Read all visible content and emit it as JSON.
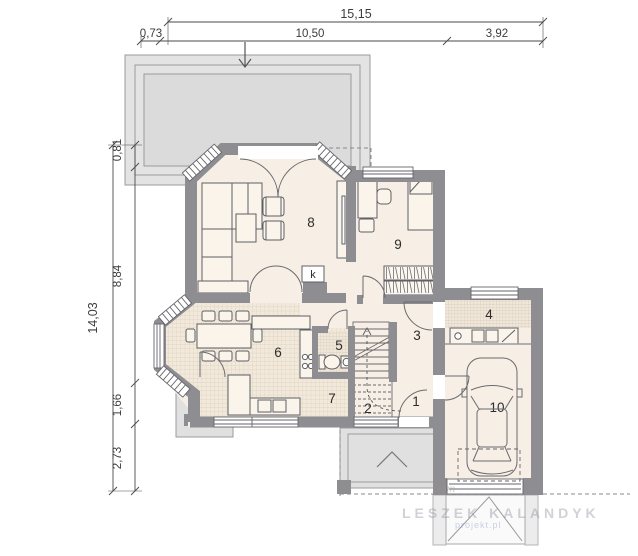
{
  "dimensions": {
    "top": {
      "total": "15,15",
      "segments": [
        "0,73",
        "10,50",
        "3,92"
      ]
    },
    "left": {
      "total": "14,03",
      "segments": [
        "0,81",
        "8,84",
        "1,66",
        "2,73"
      ]
    }
  },
  "rooms": [
    {
      "id": "room-1",
      "label": "1"
    },
    {
      "id": "room-2",
      "label": "2"
    },
    {
      "id": "room-3",
      "label": "3"
    },
    {
      "id": "room-4",
      "label": "4"
    },
    {
      "id": "room-5",
      "label": "5"
    },
    {
      "id": "room-6",
      "label": "6"
    },
    {
      "id": "room-7",
      "label": "7"
    },
    {
      "id": "room-8",
      "label": "8"
    },
    {
      "id": "room-9",
      "label": "9"
    },
    {
      "id": "room-10",
      "label": "10"
    }
  ],
  "annotations": {
    "fireplace": "k"
  },
  "watermark": {
    "designer": "LESZEK KALANDYK",
    "site": "projekt.pl",
    "script": "Dom"
  },
  "colors": {
    "wall": "#8d8d92",
    "room_fill": "#f7efe5",
    "tile_fill": "#f2e9db",
    "terrace_fill": "#e3e3e3",
    "line": "#5f5f66"
  }
}
